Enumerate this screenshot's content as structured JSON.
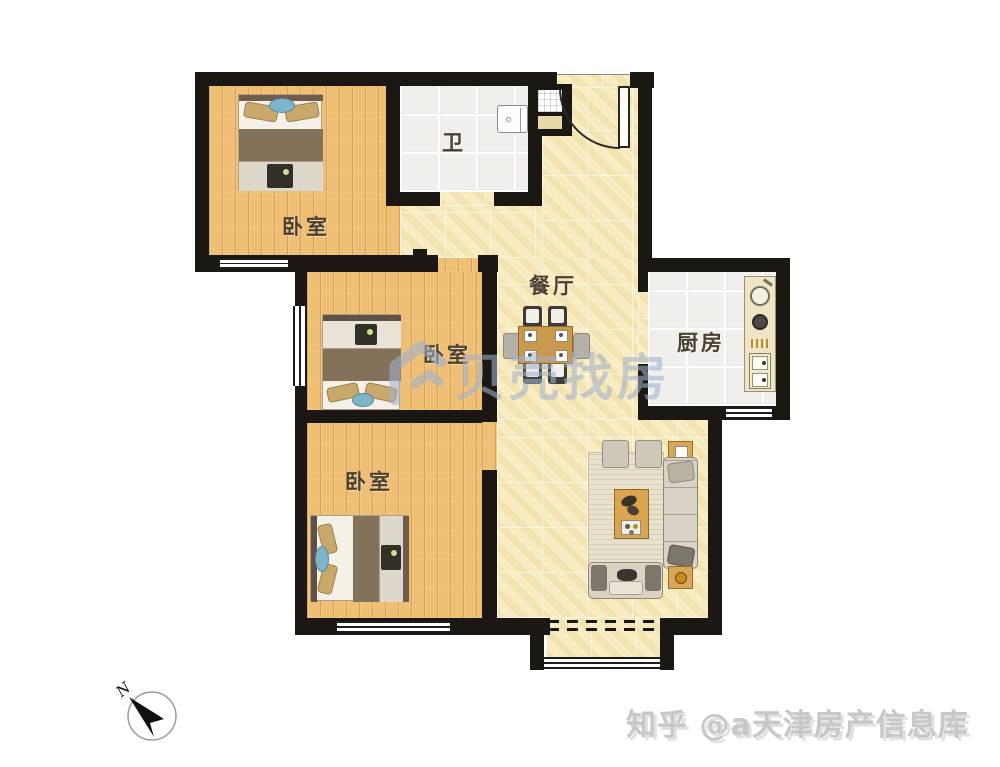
{
  "page": {
    "background": "#ffffff"
  },
  "rooms": {
    "bedroom_tl": {
      "label": "卧室"
    },
    "bathroom": {
      "label": "卫"
    },
    "dining": {
      "label": "餐厅"
    },
    "kitchen": {
      "label": "厨房"
    },
    "bedroom_mid": {
      "label": "卧室"
    },
    "bedroom_bottom": {
      "label": "卧室"
    }
  },
  "compass": {
    "north_label": "N"
  },
  "watermarks": {
    "center_brand": "贝壳找房",
    "bottom_credit": "知乎 @a天津房产信息库"
  },
  "colors": {
    "wall": "#1b1713",
    "wood_floor": "#efbf75",
    "tile_floor": "#f7ecc2",
    "white_tile": "#f0efec",
    "room_label": "#4c4030",
    "brand_watermark": "#a0b2ce",
    "credit_watermark": "#c7c7c7",
    "accent_teal": "#7eb5c8",
    "counter": "#ece4c4",
    "table_wood": "#c99a4e"
  }
}
